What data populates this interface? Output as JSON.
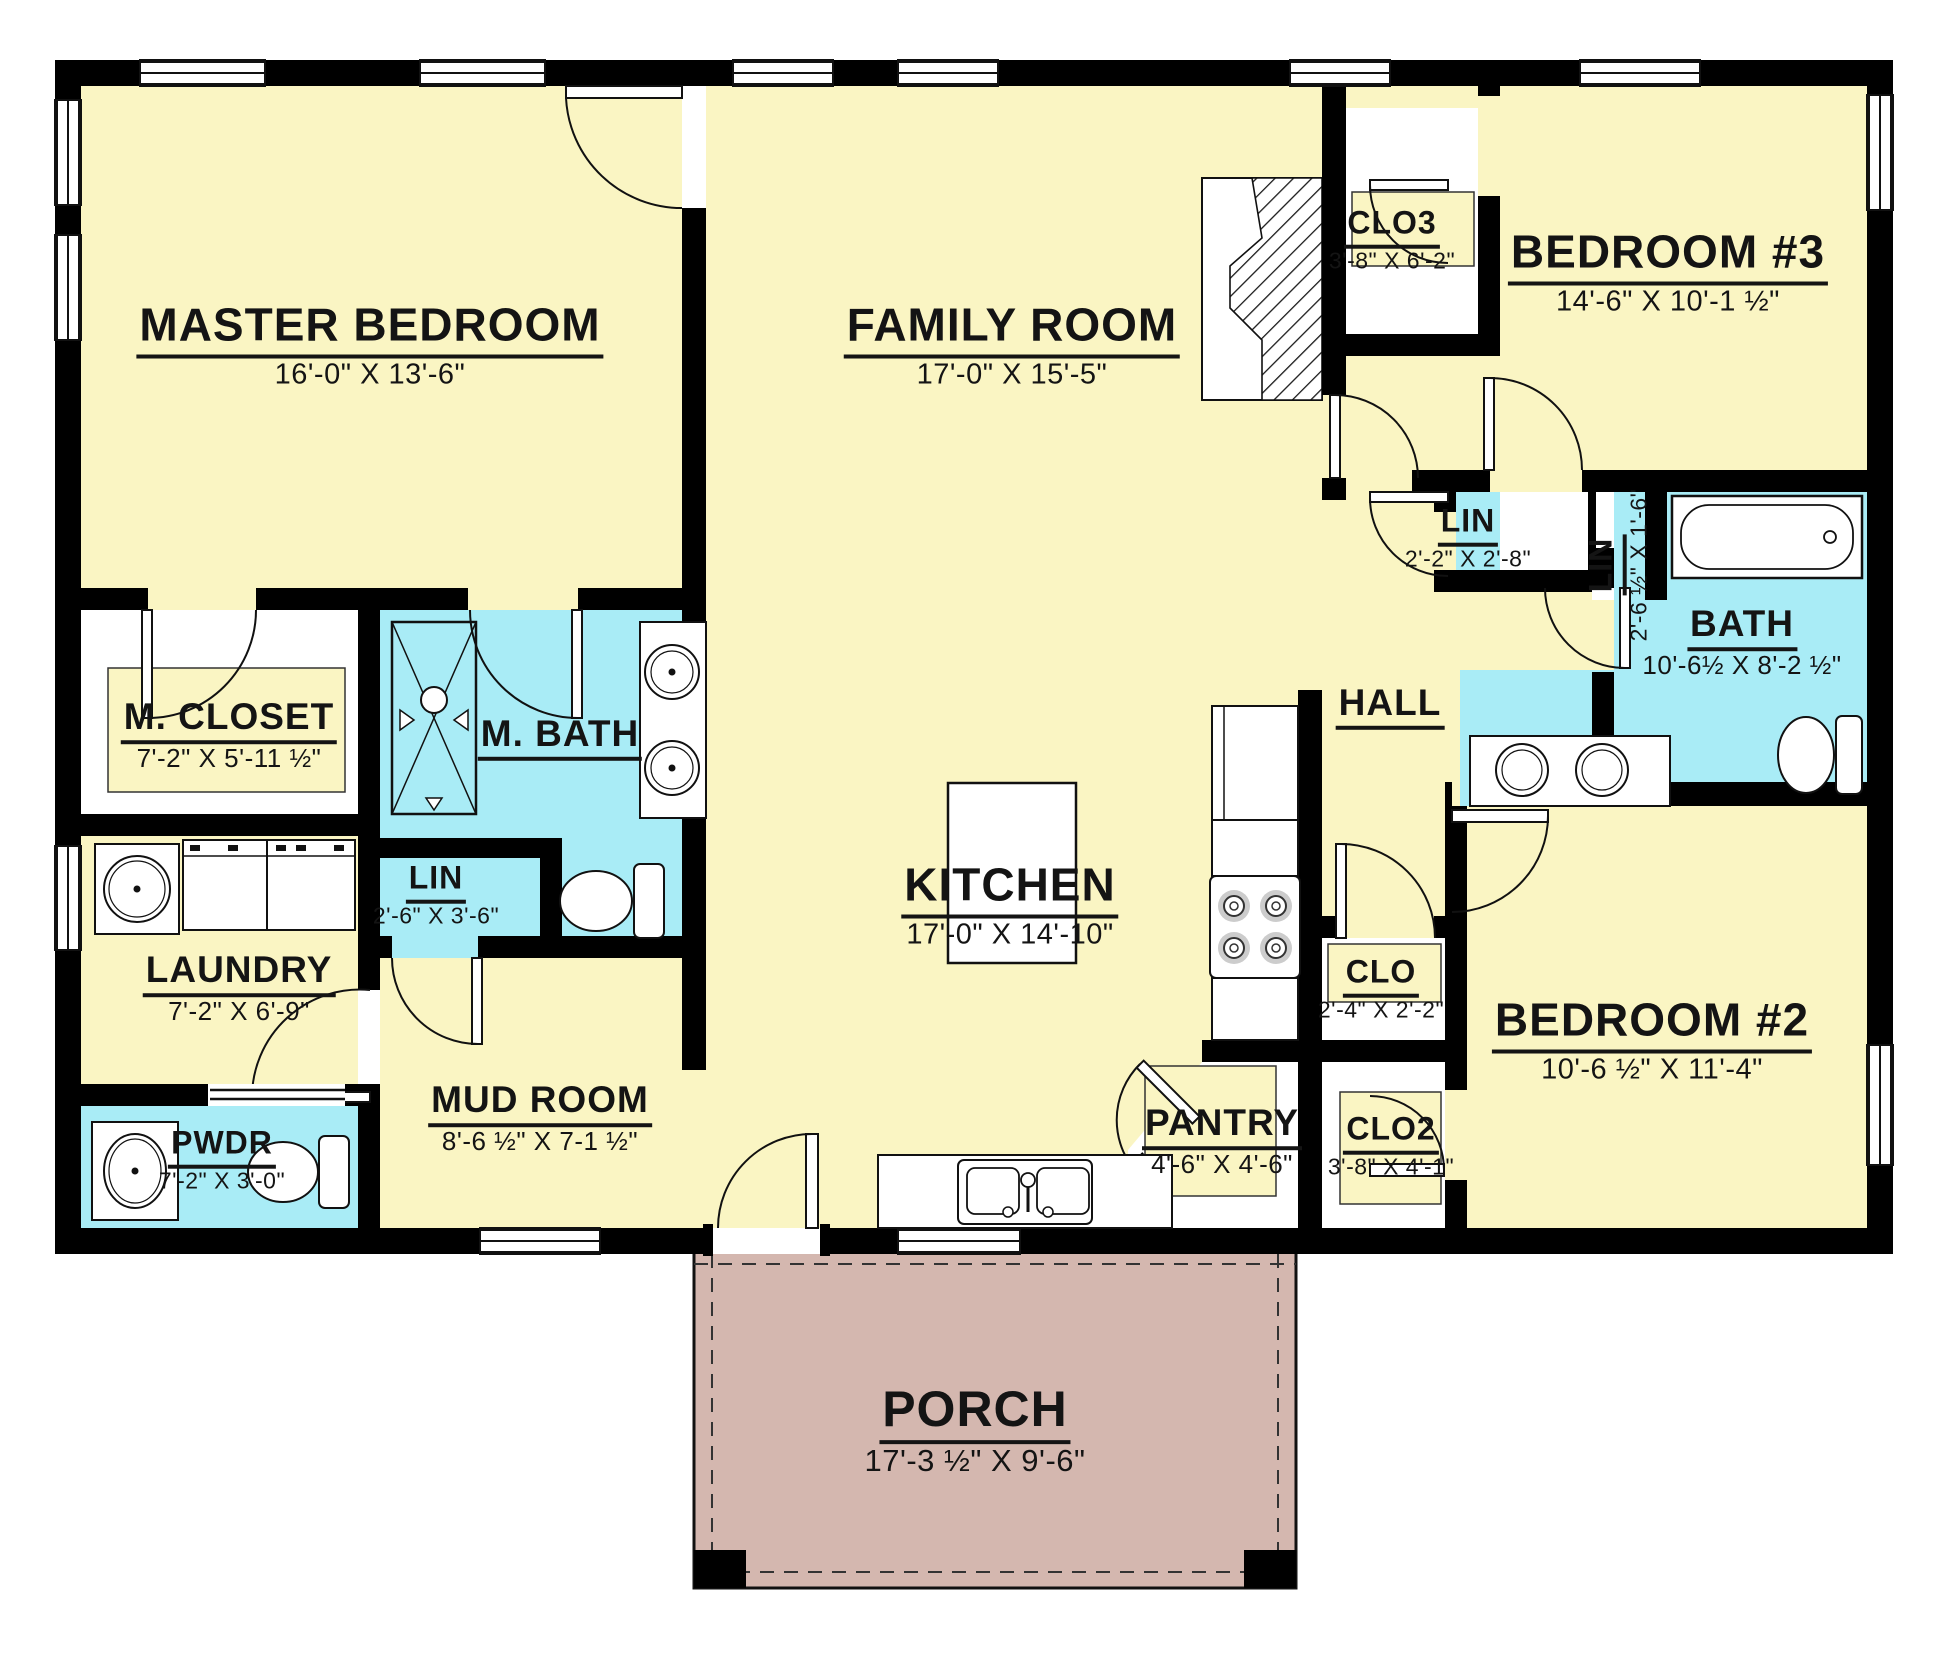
{
  "drawing_type": "residential floor plan",
  "colors": {
    "room_yellow": "#FAF5C3",
    "bath_cyan": "#A9ECF6",
    "porch_rose": "#D4B7AF",
    "wall_black": "#000000",
    "label_text": "#141414"
  },
  "rooms": {
    "master_bedroom": {
      "name": "MASTER BEDROOM",
      "dims": "16'-0\" X 13'-6\""
    },
    "family_room": {
      "name": "FAMILY ROOM",
      "dims": "17'-0\" X 15'-5\""
    },
    "clo3": {
      "name": "CLO3",
      "dims": "3'-8\" X 6'-2\""
    },
    "bedroom3": {
      "name": "BEDROOM #3",
      "dims": "14'-6\" X 10'-1 ½\""
    },
    "lin_hall": {
      "name": "LIN",
      "dims": "2'-2\" X 2'-8\""
    },
    "lin_bath": {
      "name": "LIN",
      "dims": "2'-6 ½\" X 1'-6\""
    },
    "bath": {
      "name": "BATH",
      "dims": "10'-6½ X 8'-2 ½\""
    },
    "hall": {
      "name": "HALL"
    },
    "m_closet": {
      "name": "M. CLOSET",
      "dims": "7'-2\" X 5'-11 ½\""
    },
    "m_bath": {
      "name": "M. BATH"
    },
    "lin_mbath": {
      "name": "LIN",
      "dims": "2'-6\" X 3'-6\""
    },
    "laundry": {
      "name": "LAUNDRY",
      "dims": "7'-2\" X 6'-9\""
    },
    "kitchen": {
      "name": "KITCHEN",
      "dims": "17'-0\" X 14'-10\""
    },
    "clo": {
      "name": "CLO",
      "dims": "2'-4\" X 2'-2\""
    },
    "bedroom2": {
      "name": "BEDROOM #2",
      "dims": "10'-6 ½\" X 11'-4\""
    },
    "pwdr": {
      "name": "PWDR",
      "dims": "7'-2\" X 3'-0\""
    },
    "mud_room": {
      "name": "MUD ROOM",
      "dims": "8'-6 ½\" X 7-1 ½\""
    },
    "pantry": {
      "name": "PANTRY",
      "dims": "4'-6\" X 4'-6\""
    },
    "clo2": {
      "name": "CLO2",
      "dims": "3'-8\" X 4'-1\""
    },
    "porch": {
      "name": "PORCH",
      "dims": "17'-3 ½\" X 9'-6\""
    }
  }
}
